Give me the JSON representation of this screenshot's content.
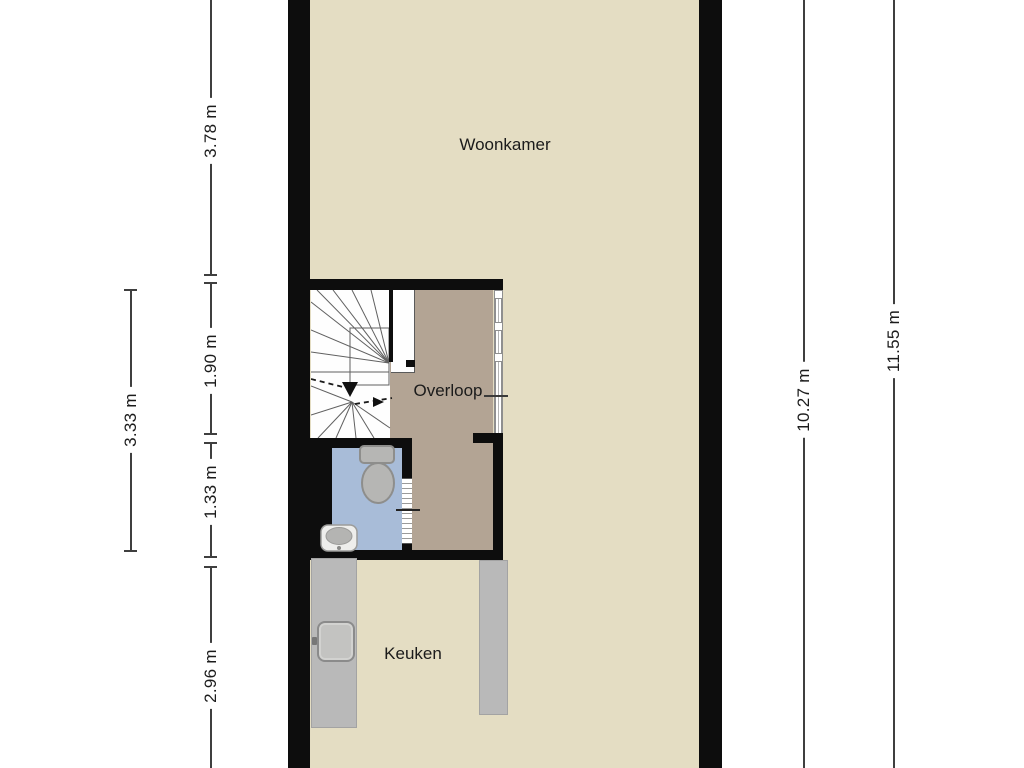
{
  "plan": {
    "rooms": [
      {
        "id": "woonkamer",
        "label": "Woonkamer"
      },
      {
        "id": "overloop",
        "label": "Overloop"
      },
      {
        "id": "keuken",
        "label": "Keuken"
      }
    ]
  },
  "dimensions": {
    "left_outer": {
      "label": "3.33 m"
    },
    "left_inner": [
      {
        "label": "3.78 m"
      },
      {
        "label": "1.90 m"
      },
      {
        "label": "1.33 m"
      },
      {
        "label": "2.96 m"
      }
    ],
    "right": [
      {
        "label": "10.27 m"
      },
      {
        "label": "11.55 m"
      }
    ]
  },
  "colors": {
    "wall": "#0d0d0d",
    "floor_main": "#e4ddc3",
    "floor_overloop": "#b3a494",
    "floor_bathroom": "#a8bcd8",
    "floor_stairs": "#fefefe",
    "counter": "#b9b9b9",
    "window_frame": "#8f8f8f",
    "dimension_line": "#3f3f3f",
    "label_text": "#1b1b1b"
  },
  "icons": {
    "toilet": "toilet-icon",
    "bathroom_sink": "sink-icon",
    "kitchen_sink": "kitchen-sink-icon",
    "window": "window-icon",
    "stairs": "stairs-icon",
    "stairs_direction": "arrow-down-icon"
  }
}
